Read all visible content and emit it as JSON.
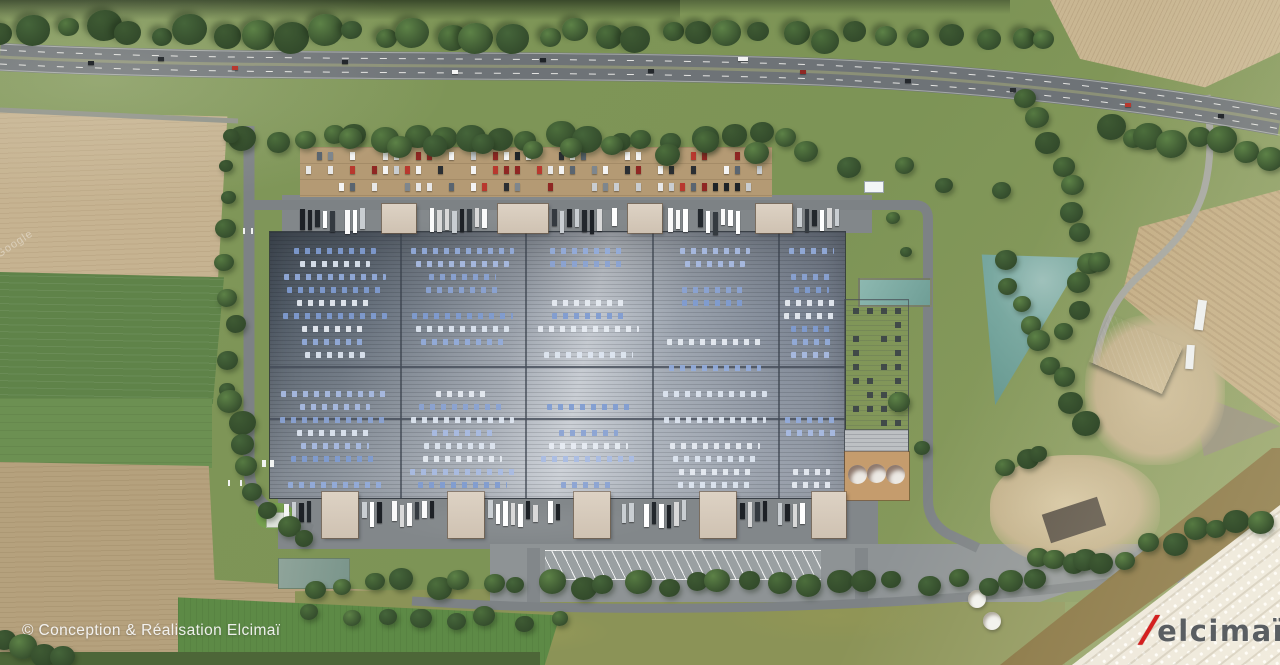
{
  "image": {
    "type": "aerial architectural rendering",
    "subject": "logistics warehouse site plan with highway, fields, ponds and parking"
  },
  "overlay": {
    "caption": "© Conception & Réalisation Elcimaï",
    "watermark": "Google",
    "logo": {
      "slash": "/",
      "text": "elcimaï"
    }
  },
  "palette": {
    "accent_red": "#d41f1f",
    "logo_gray": "#5a5e62",
    "roof_gray": "#79828e",
    "skylight_blue": "#8ca6d8",
    "grass_green": "#7e9557",
    "field_tan": "#c3b190",
    "pond_teal": "#74a49c",
    "road_gray": "#7d8285"
  }
}
